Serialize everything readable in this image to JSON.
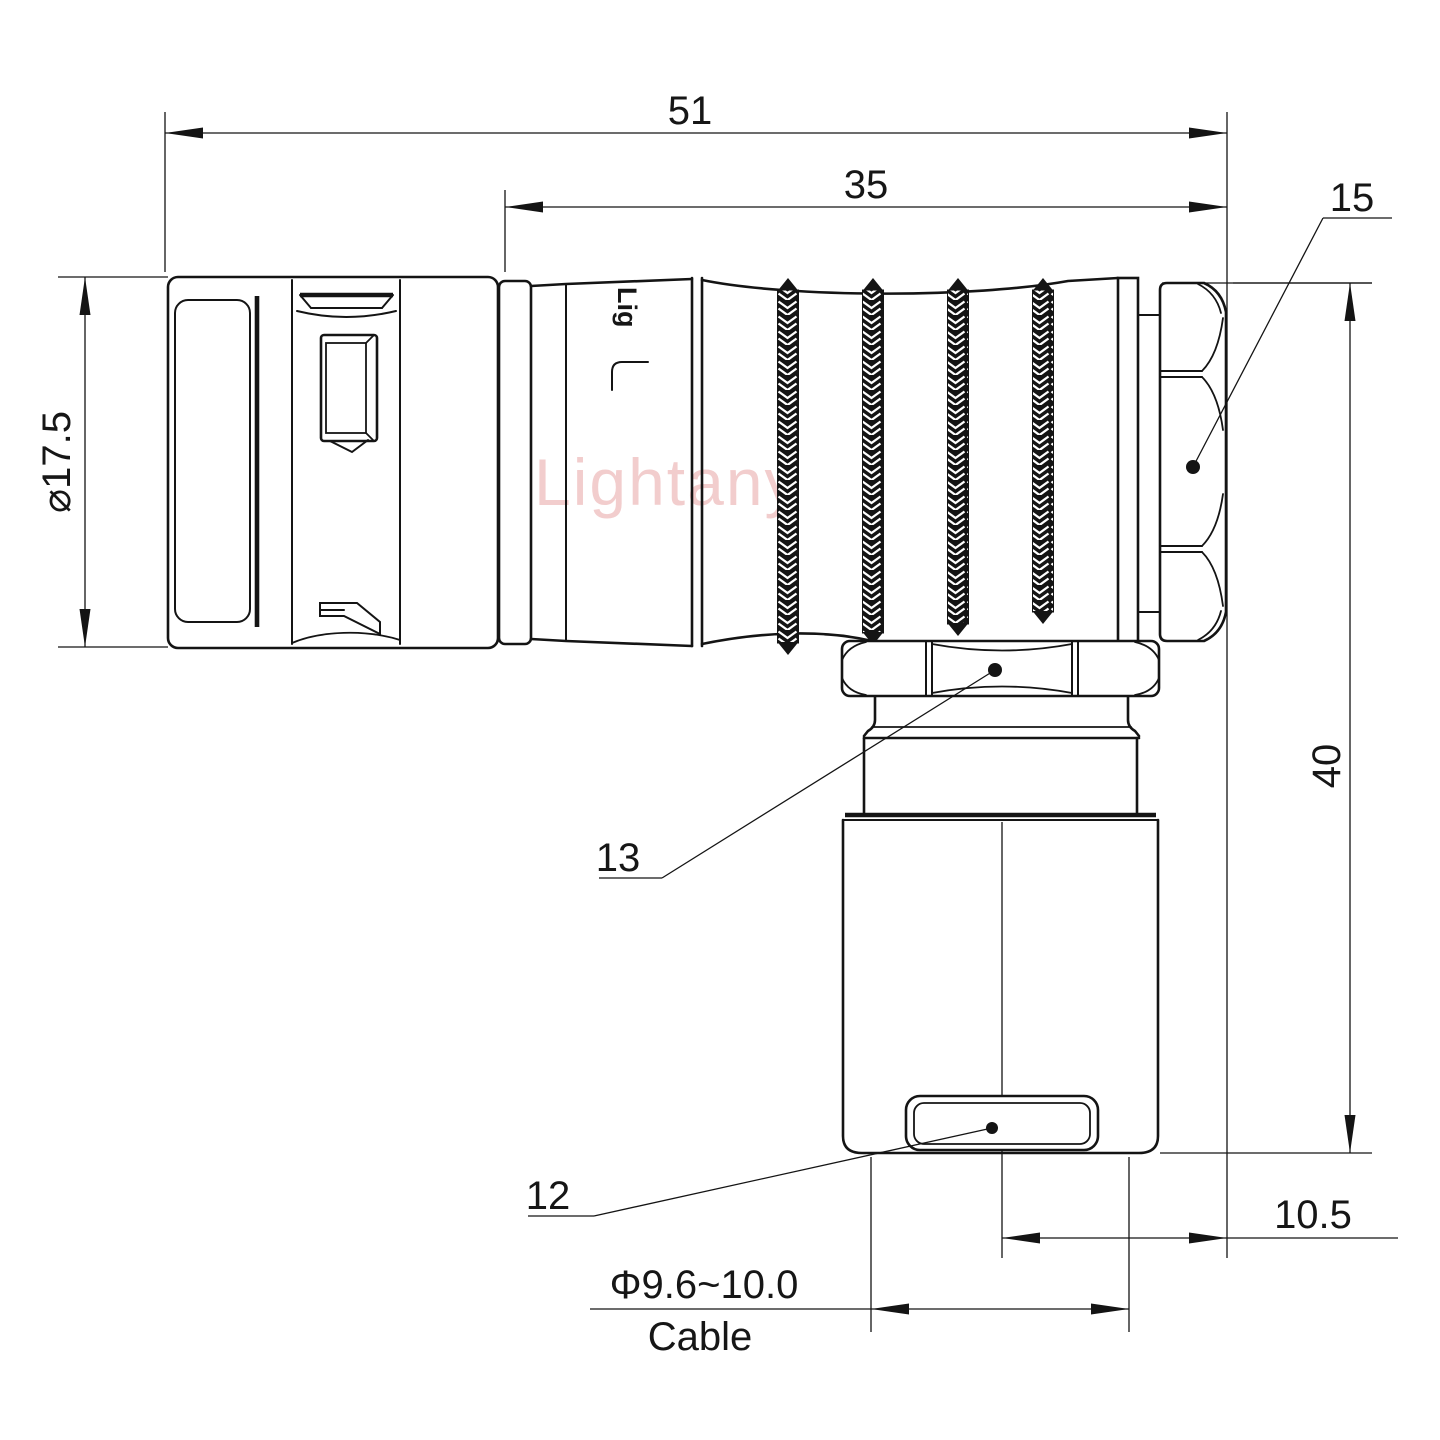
{
  "drawing": {
    "watermark": "Lightany",
    "brand_marking": "Lig",
    "dimensions": {
      "overall_length": "51",
      "rear_section_length": "35",
      "front_diameter": "⌀17.5",
      "overall_height": "40",
      "center_offset": "10.5",
      "cable_range": "Φ9.6~10.0",
      "cable_word": "Cable"
    },
    "part_labels": {
      "back_nut": "15",
      "coupling_nut": "13",
      "cable_clamp": "12"
    },
    "colors": {
      "line": "#141414",
      "watermark": "#e8a6a6"
    }
  }
}
